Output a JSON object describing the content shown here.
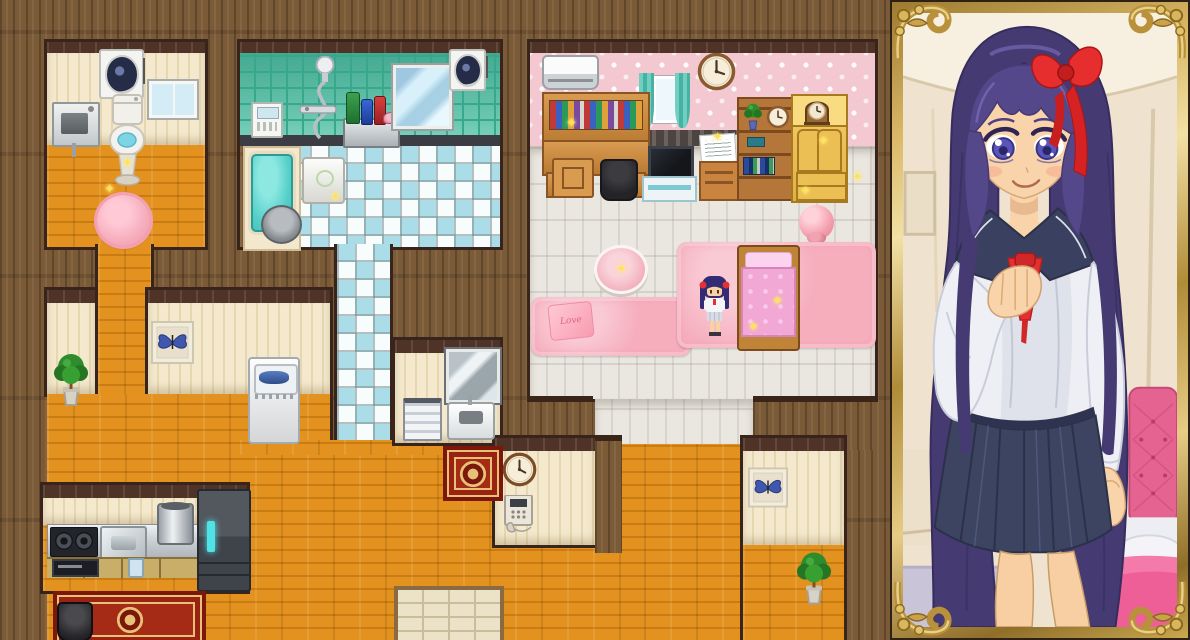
{
  "scene": {
    "description": "Top-down RPG house interior map with an ornately framed anime character portrait panel on the right",
    "map": {
      "rooms": [
        {
          "name": "toilet-room",
          "objects": [
            "ventilation-fan",
            "window",
            "wall-sink",
            "toilet",
            "pink-round-rug"
          ]
        },
        {
          "name": "bathroom",
          "objects": [
            "control-panel",
            "shower",
            "toiletry-shelf-with-bottles",
            "wall-mirror",
            "ventilation-fan",
            "bathtub",
            "wash-bucket",
            "bath-stool",
            "checkered-tile-floor"
          ]
        },
        {
          "name": "bedroom",
          "objects": [
            "air-conditioner",
            "wall-clock",
            "curtained-window",
            "study-desk-with-books",
            "chair",
            "trash-bin",
            "tv-on-stand",
            "nightstand-with-papers",
            "bookshelf",
            "golden-wardrobe",
            "mantel-clock",
            "pink-ball",
            "round-pink-table",
            "pink-rug-with-love-pillow",
            "pink-bed",
            "character-sprite",
            "pink-shag-rug"
          ]
        },
        {
          "name": "hallway",
          "objects": [
            "potted-plant",
            "butterfly-picture",
            "washing-machine"
          ]
        },
        {
          "name": "washroom",
          "objects": [
            "wall-mirror",
            "towel-rack",
            "small-sink",
            "red-rug"
          ]
        },
        {
          "name": "kitchen",
          "objects": [
            "gas-stove",
            "kitchen-sink",
            "counter",
            "stock-pot",
            "oven",
            "cup",
            "refrigerator",
            "ornate-red-rug",
            "black-pot"
          ]
        },
        {
          "name": "phone-nook",
          "objects": [
            "wall-clock",
            "wall-phone"
          ]
        },
        {
          "name": "entry",
          "objects": [
            "stone-entry-mat"
          ]
        },
        {
          "name": "south-room",
          "objects": [
            "butterfly-picture",
            "potted-plant"
          ]
        }
      ],
      "pillow_text": "Love",
      "sprite": {
        "description": "small girl sprite, dark blue hair with red bows, white top, light skirt, standing beside pink bed"
      }
    },
    "portrait": {
      "frame": "ornate gold picture frame with scroll corners",
      "subject": "smiling girl, long indigo hair, red hair bow, violet eyes, navy sailor school uniform with red neckerchief, navy pleated skirt, hand on chest",
      "background": "bedroom interior with ceiling light and pink tufted bed"
    }
  },
  "glyphs": {
    "sparkle": "✦"
  },
  "palette": {
    "wood-wall": "#7b5a37",
    "trim-dark": "#4e3326",
    "floor-orange": "#e3921f",
    "floor-orange-line": "#c87c12",
    "wall-cream": "#f2e5c6",
    "tile-teal": "#4ec0a4",
    "tile-teal-line": "#38a78c",
    "checker-blue": "#abdde9",
    "checker-white": "#f7fcfd",
    "wallpaper-pink": "#f3c8d0",
    "floor-white": "#eae7e0",
    "floor-white-line": "#d9d5cc",
    "rug-pink": "#f6aebd",
    "bed-pink": "#f2a8d4",
    "rug-red": "#a62b17",
    "rug-red-border": "#7c170c",
    "rug-gold": "#e7c276",
    "frame-gold": "#d4b266",
    "frame-edge": "#2e2014",
    "hair-indigo": "#453a72",
    "skin": "#f9d3a9",
    "uniform-navy": "#3a4160",
    "blouse-white": "#edeff4",
    "accent-red": "#e53030",
    "eye-violet": "#5a54bc"
  }
}
